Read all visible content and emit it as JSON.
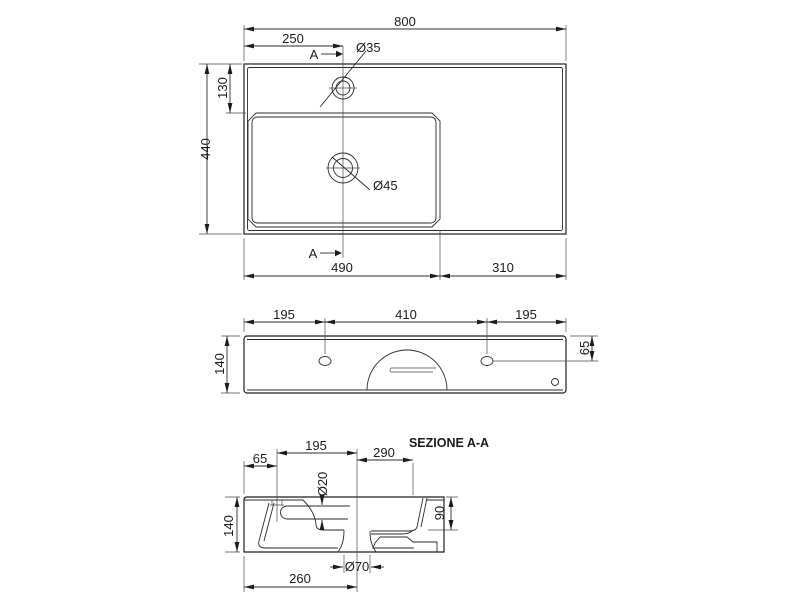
{
  "drawing": {
    "line_color": "#1f1f1f",
    "background": "#ffffff",
    "plan": {
      "overall_width": "800",
      "faucet_offset": "250",
      "faucet_dia": "Ø35",
      "section_marker": "A",
      "rim_to_basin": "130",
      "overall_depth": "440",
      "drain_dia": "Ø45",
      "basin_span": "490",
      "deck_span": "310"
    },
    "front": {
      "hole_left": "195",
      "hole_spacing": "410",
      "hole_right": "195",
      "height": "140",
      "hole_from_top": "65"
    },
    "section": {
      "title": "SEZIONE A-A",
      "back_offset": "65",
      "faucet_to_drain": "195",
      "drain_to_rim": "290",
      "overflow_dia": "Ø20",
      "basin_depth": "90",
      "height": "140",
      "drain_offset": "260",
      "waste_dia": "Ø70"
    }
  }
}
